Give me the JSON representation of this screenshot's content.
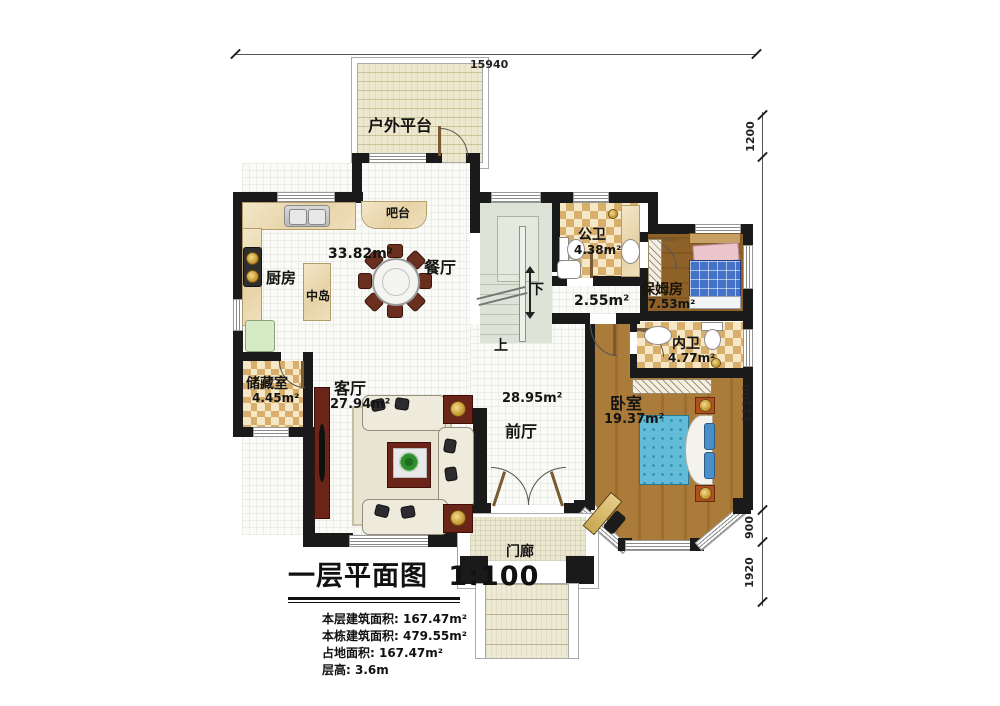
{
  "plan": {
    "dimensions": {
      "top": "15940",
      "right": [
        "1200",
        "11100",
        "900",
        "1920"
      ]
    },
    "rooms": {
      "platform": {
        "name": "户外平台"
      },
      "bar": {
        "name": "吧台"
      },
      "kitchen": {
        "name": "厨房"
      },
      "island": {
        "name": "中岛"
      },
      "dining": {
        "name": "餐厅",
        "area": "33.82m²"
      },
      "public_bath": {
        "name": "公卫",
        "area": "4.38m²"
      },
      "corridor": {
        "area": "2.55m²"
      },
      "nanny_room": {
        "name": "保姆房",
        "area": "7.53m²"
      },
      "inner_bath": {
        "name": "内卫",
        "area": "4.77m²"
      },
      "storage": {
        "name": "储藏室",
        "area": "4.45m²"
      },
      "living": {
        "name": "客厅",
        "area": "27.94m²"
      },
      "foyer": {
        "name": "前厅",
        "area": "28.95m²"
      },
      "bedroom": {
        "name": "卧室",
        "area": "19.37m²"
      },
      "porch": {
        "name": "门廊"
      }
    },
    "stairs": {
      "up": "上",
      "down": "下"
    }
  },
  "title_block": {
    "title": "一层平面图",
    "scale": "1:100",
    "info": [
      "本层建筑面积: 167.47m²",
      "本栋建筑面积: 479.55m²",
      "占地面积: 167.47m²",
      "层高: 3.6m"
    ]
  },
  "colors": {
    "wall": "#1a1a1a",
    "accent_red": "#6b2418",
    "checker": "#d8ae6c",
    "stair": "#dde3d6",
    "bed_blue": "#5fc0dc"
  }
}
